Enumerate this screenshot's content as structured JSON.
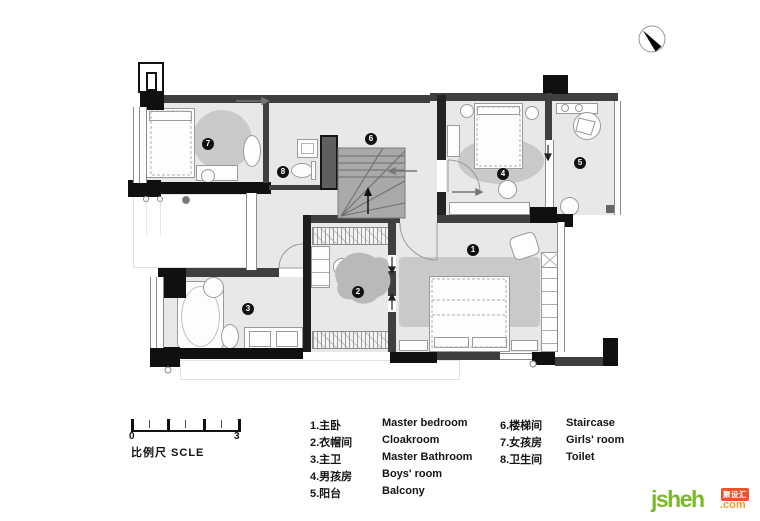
{
  "north_arrow": {
    "icon": "compass-north"
  },
  "scale_bar": {
    "min": "0",
    "max": "3",
    "label": "比例尺 SCLE"
  },
  "plan": {
    "markers": [
      "1",
      "2",
      "3",
      "4",
      "5",
      "6",
      "7",
      "8"
    ]
  },
  "legend": {
    "left": [
      {
        "zh": "1.主卧",
        "en": "Master bedroom"
      },
      {
        "zh": "2.衣帽间",
        "en": "Cloakroom"
      },
      {
        "zh": "3.主卫",
        "en": "Master Bathroom"
      },
      {
        "zh": "4.男孩房",
        "en": "Boys' room"
      },
      {
        "zh": "5.阳台",
        "en": "Balcony"
      }
    ],
    "right": [
      {
        "zh": "6.楼梯间",
        "en": "Staircase"
      },
      {
        "zh": "7.女孩房",
        "en": "Girls' room"
      },
      {
        "zh": "8.卫生间",
        "en": "Toilet"
      }
    ]
  },
  "watermark": {
    "brand": "jsheh",
    "badge": "聚设汇",
    "suffix": ".com"
  },
  "colors": {
    "wall": "#3f3f3f",
    "wall_black": "#101010",
    "room_fill": "#e8e8e8",
    "rug": "#c9c9c9",
    "stair": "#a9a9a9",
    "brand_green": "#7ab929",
    "brand_orange": "#f49a1f",
    "badge_red": "#e8542a"
  }
}
